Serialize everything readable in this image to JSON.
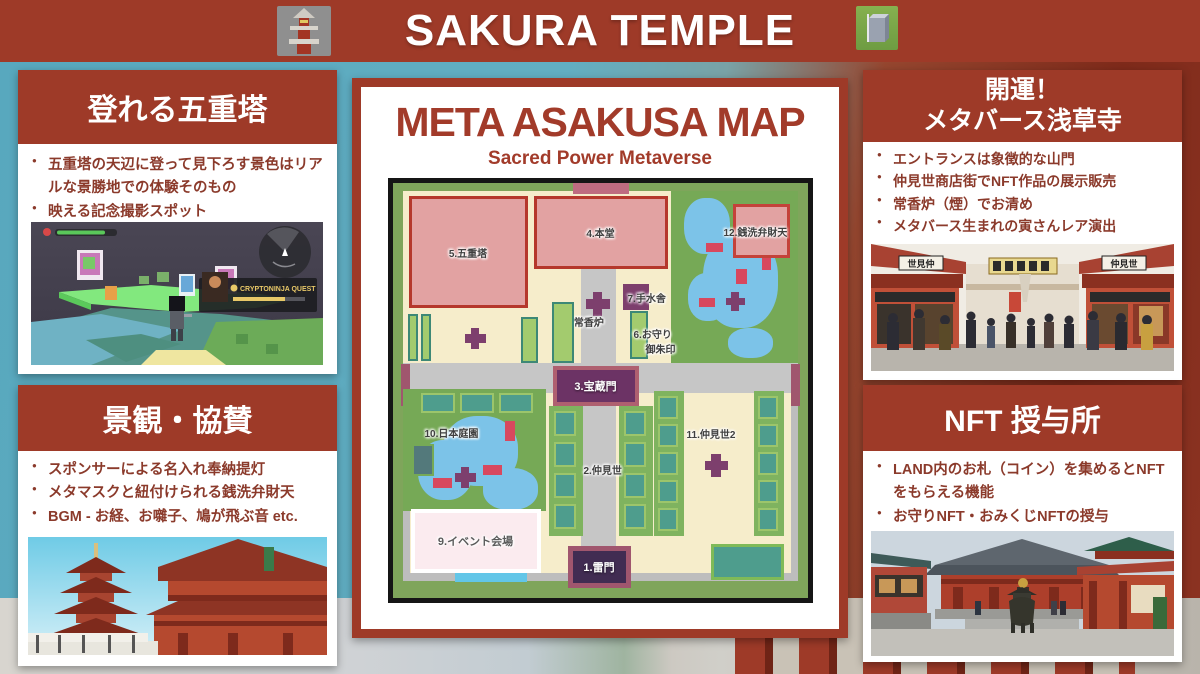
{
  "banner": {
    "title": "SAKURA TEMPLE",
    "left_icon": "pagoda-3d-icon",
    "right_icon": "cube-3d-icon"
  },
  "panels": {
    "pagoda": {
      "title": "登れる五重塔",
      "bullets": [
        "五重塔の天辺に登って見下ろす景色はリアルな景勝地での体験そのもの",
        "映える記念撮影スポット"
      ]
    },
    "scenery": {
      "title": "景観・協賛",
      "bullets": [
        "スポンサーによる名入れ奉納提灯",
        "メタマスクと紐付けられる銭洗弁財天",
        "BGM - お経、お囃子、鳩が飛ぶ音 etc."
      ]
    },
    "luck": {
      "title_line1": "開運！",
      "title_line2": "メタバース浅草寺",
      "bullets": [
        "エントランスは象徴的な山門",
        "仲見世商店街でNFT作品の展示販売",
        "常香炉（煙）でお清め",
        "メタバース生まれの寅さんレア演出"
      ]
    },
    "nft": {
      "title": "NFT 授与所",
      "bullets": [
        "LAND内のお札（コイン）を集めるとNFTをもらえる機能",
        "お守りNFT・おみくじNFTの授与"
      ]
    }
  },
  "map_panel": {
    "title": "META ASAKUSA MAP",
    "subtitle": "Sacred Power Metaverse",
    "locations": [
      {
        "label": "1.雷門"
      },
      {
        "label": "2.仲見世"
      },
      {
        "label": "3.宝蔵門"
      },
      {
        "label": "4.本堂"
      },
      {
        "label": "5.五重塔"
      },
      {
        "label": "6.お守り",
        "label2": "御朱印"
      },
      {
        "label": "7.手水舎"
      },
      {
        "label": "8.常香炉"
      },
      {
        "label": "9.イベント会場"
      },
      {
        "label": "10.日本庭園"
      },
      {
        "label": "11.仲見世2"
      },
      {
        "label": "12.銭洗弁財天"
      }
    ]
  },
  "images": {
    "game": {
      "quest_title": "CRYPTONINJA QUEST"
    },
    "street": {
      "left_sign": "世見仲",
      "right_sign": "仲見世"
    }
  },
  "colors": {
    "accent_red": "#9E3A28",
    "bullet_text": "#8B3A2B",
    "map_cream": "#F6EDCB",
    "map_green": "#76A956",
    "map_pond_blue": "#7CC3E8",
    "map_building_pink": "#E2A2A2",
    "map_purple": "#7D3F6D",
    "map_teal": "#4E9D8D"
  }
}
